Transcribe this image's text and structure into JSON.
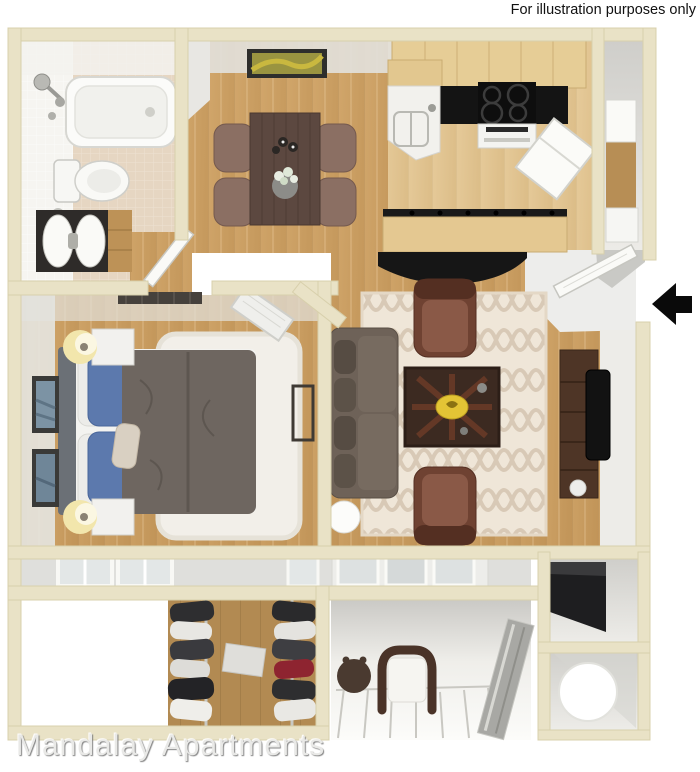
{
  "header": {
    "disclaimer": "For illustration purposes only"
  },
  "footer": {
    "brand": "Mandalay Apartments"
  },
  "palette": {
    "wall_cream": "#E9E2C6",
    "wall_edge": "#D8D0AC",
    "wood_floor": "#C89C60",
    "kitchen_wood": "#DEC08E",
    "closet_wood": "#B28A52",
    "bath_floor_tile": "#E6D6C2",
    "bath_wall_tile": "#F6F5F1",
    "living_rug": "#EFE6D8",
    "rug_pattern": "#D8C9B6",
    "bedroom_rug": "#F2EFE9",
    "sofa_gray_brown": "#6E6258",
    "armchair_leather": "#6F4232",
    "dining_table": "#5C4840",
    "counter_black": "#141414",
    "pillow_blue": "#5C79AD",
    "comforter_gray": "#6E6660",
    "bowl_gold": "#E3C435",
    "entry_arrow": "#0A0A0A",
    "disclaimer_text": "#111111",
    "brand_text": "#E9E9E7"
  }
}
